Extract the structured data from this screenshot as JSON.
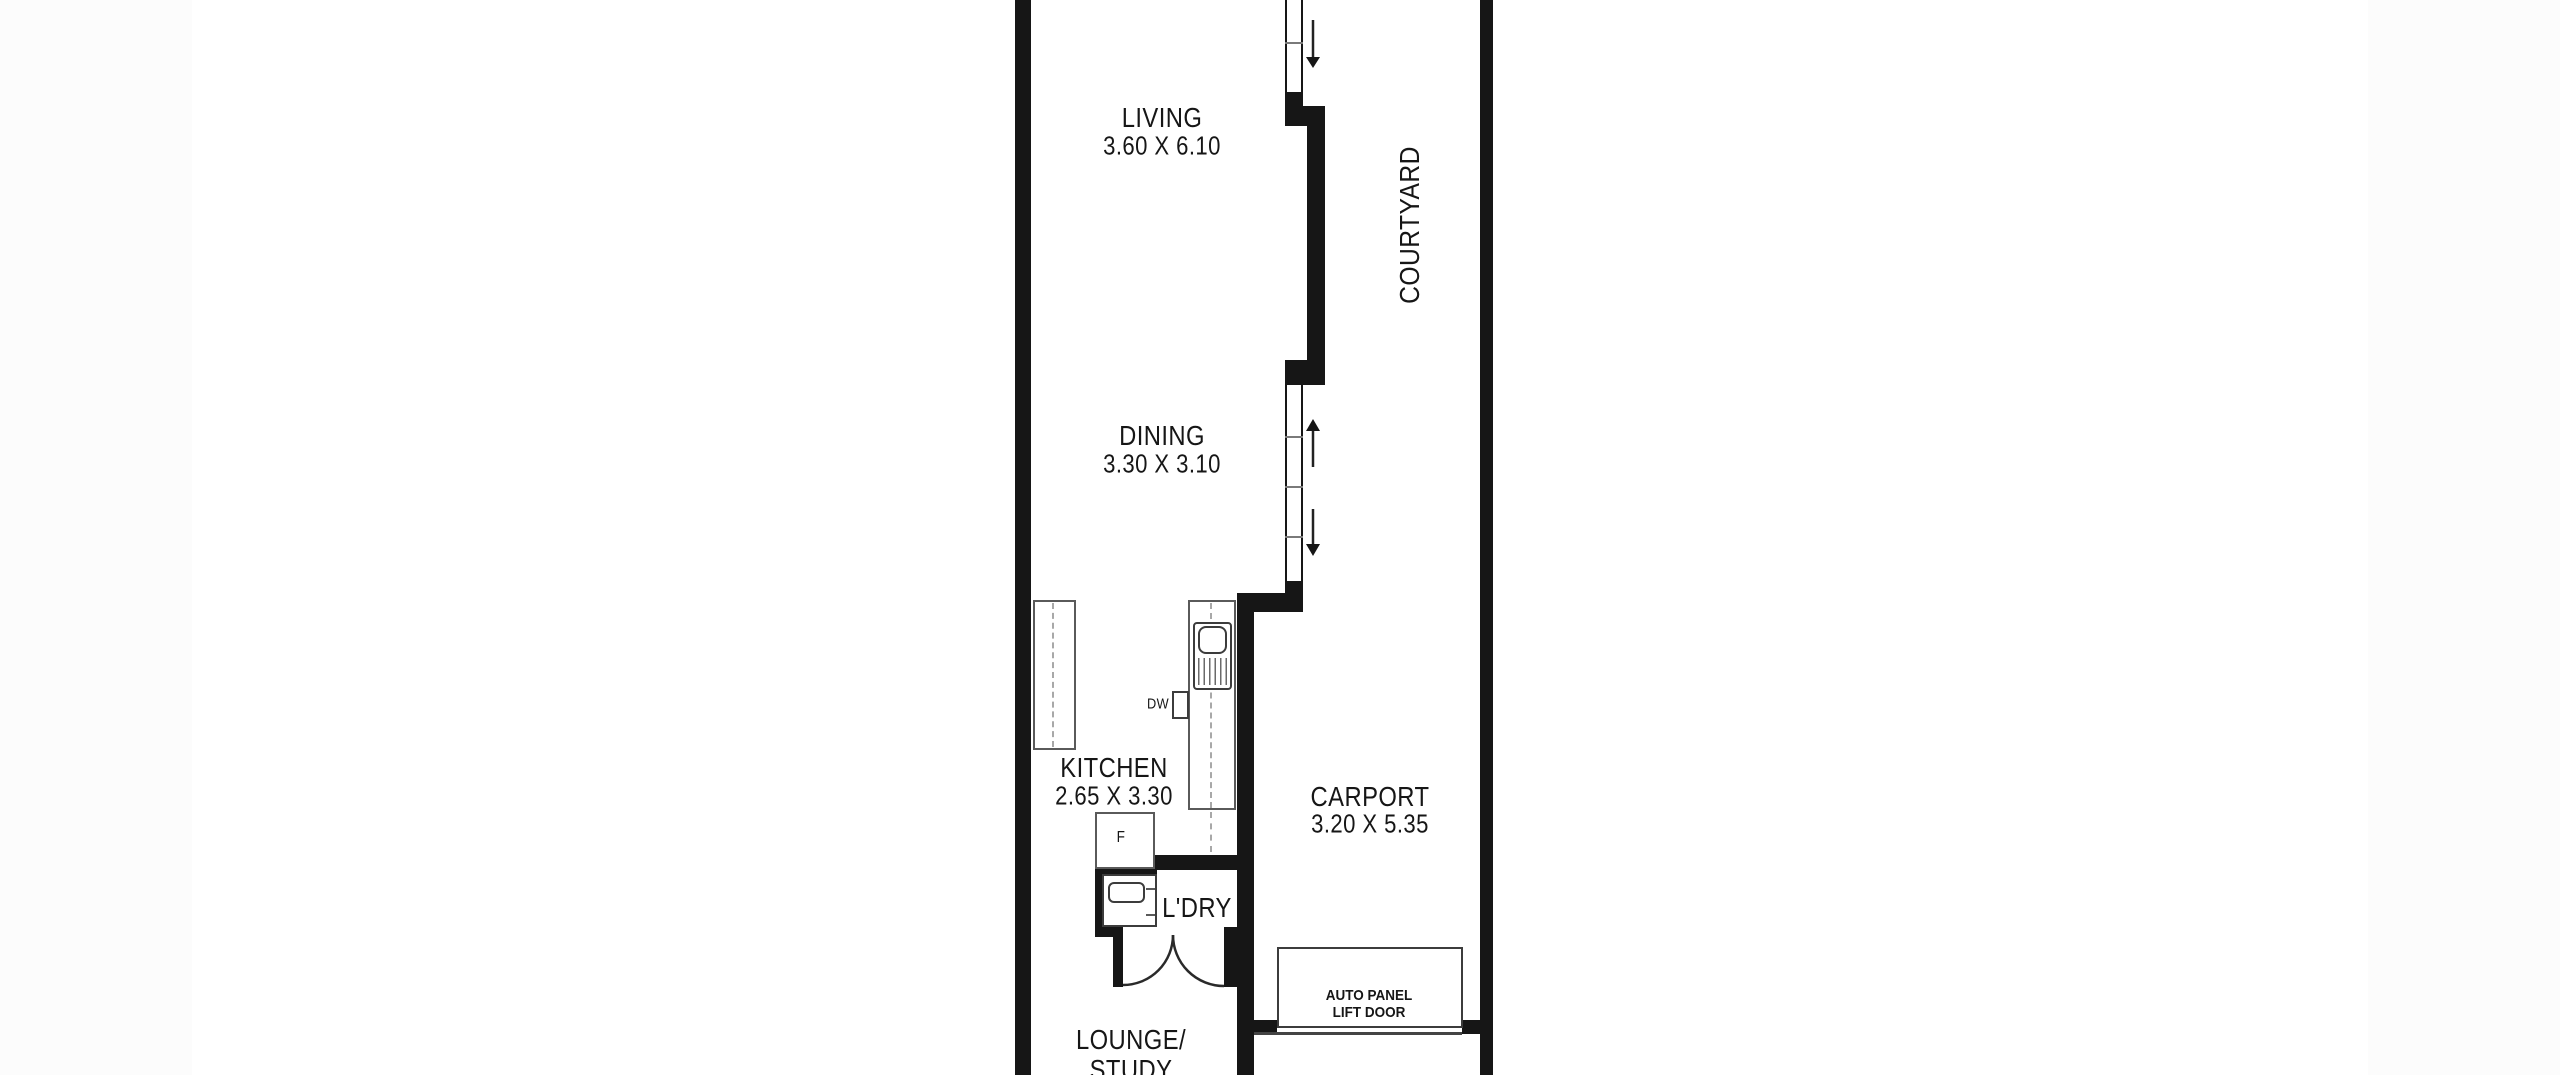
{
  "colors": {
    "wall": "#161616",
    "text": "#161616",
    "fixture_line": "#5a5a5a",
    "dashed_line": "#a8a8a8",
    "sheet_background": "#ffffff",
    "page_background": "#fcfcfc"
  },
  "rooms": {
    "living": {
      "label": "LIVING",
      "dims": "3.60 X 6.10"
    },
    "dining": {
      "label": "DINING",
      "dims": "3.30 X 3.10"
    },
    "kitchen": {
      "label": "KITCHEN",
      "dims": "2.65 X 3.30"
    },
    "carport": {
      "label": "CARPORT",
      "dims": "3.20 X 5.35"
    },
    "courtyard": {
      "label": "COURTYARD"
    },
    "laundry": {
      "label": "L'DRY"
    },
    "lounge": {
      "line1": "LOUNGE/",
      "line2": "STUDY"
    }
  },
  "fixtures": {
    "fridge_label": "F",
    "dishwasher_label": "DW"
  },
  "garage_door": {
    "line1": "AUTO PANEL",
    "line2": "LIFT DOOR"
  }
}
